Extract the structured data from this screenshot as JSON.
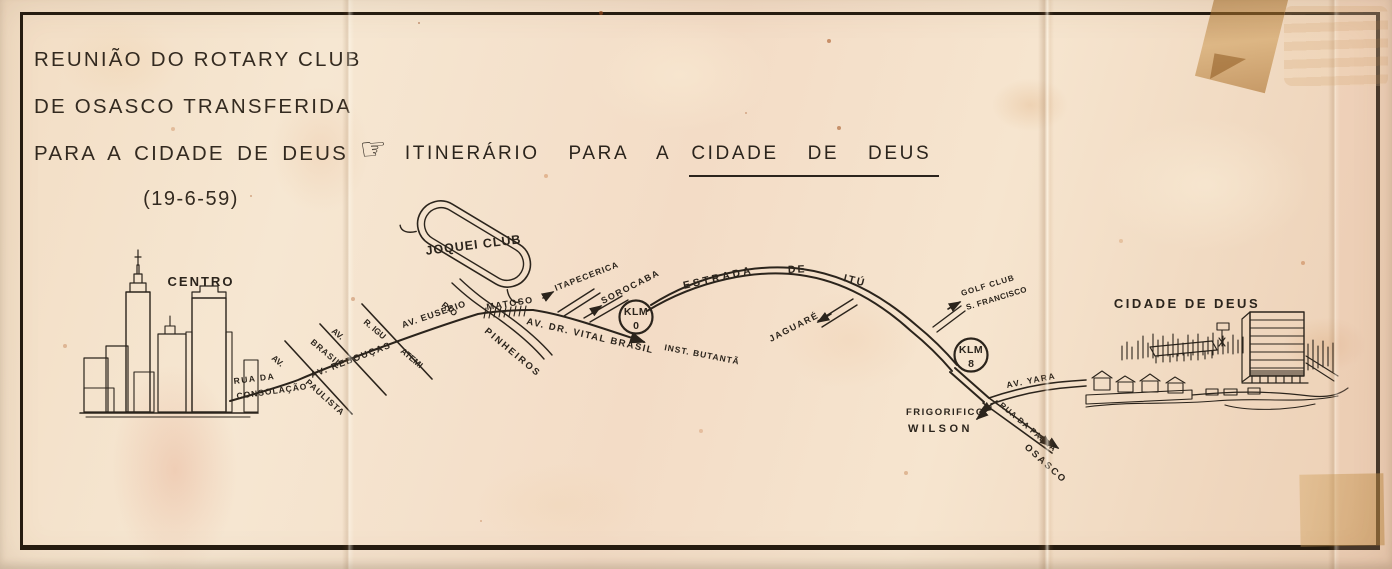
{
  "document": {
    "kind": "scanned hand-drawn itinerary map",
    "header": {
      "line1": "REUNIÃO DO ROTARY CLUB",
      "line2": "DE OSASCO TRANSFERIDA",
      "line3": "PARA A CIDADE DE DEUS",
      "date": "(19-6-59)"
    },
    "title": {
      "hand_icon": "☞",
      "prefix": "ITINERÁRIO PARA A",
      "destination": "CIDADE DE DEUS"
    }
  },
  "map": {
    "places": {
      "centro": "CENTRO",
      "joquei_club": "JOQUEI CLUB",
      "cidade_de_deus": "CIDADE DE DEUS",
      "inst_butanta": "INST. BUTANTÃ",
      "golf_club_line1": "GOLF CLUB",
      "golf_club_line2": "S. FRANCISCO",
      "frigorifico_line1": "FRIGORIFICO",
      "frigorifico_line2": "WILSON",
      "jaguare": "JAGUARÉ",
      "itapecerica": "ITAPECERICA",
      "sorocaba": "SOROCABA",
      "osasco": "OSASCO"
    },
    "roads": {
      "rua_da": "RUA DA",
      "consolacao": "CONSOLAÇÃO",
      "av_paulista_prefix": "AV.",
      "paulista": "PAULISTA",
      "av_brasil_prefix": "AV.",
      "brasil": "BRASIL",
      "av_reboucas": "AV. REBOUÇAS",
      "r_igu": "R. IGU",
      "atemi": "ATEMI",
      "av_eusebio": "AV. EUSEBIO",
      "matoso": "MATOSO",
      "rio": "RIO",
      "pinheiros": "PINHEIROS",
      "av_dr_vital_brasil": "AV. DR. VITAL BRASIL",
      "estrada": "ESTRADA",
      "de": "DE",
      "itu": "ITÚ",
      "av_yara": "AV. YARA",
      "rua_da_palha": "RUA DA PALHA"
    },
    "markers": {
      "klm0_top": "KLM",
      "klm0_num": "0",
      "klm8_top": "KLM",
      "klm8_num": "8"
    }
  },
  "colors": {
    "paper": "#f4e2cb",
    "ink": "#2b241c",
    "stain_rust": "#b96b3a",
    "tape": "#c08b43",
    "frame": "#241b10"
  }
}
